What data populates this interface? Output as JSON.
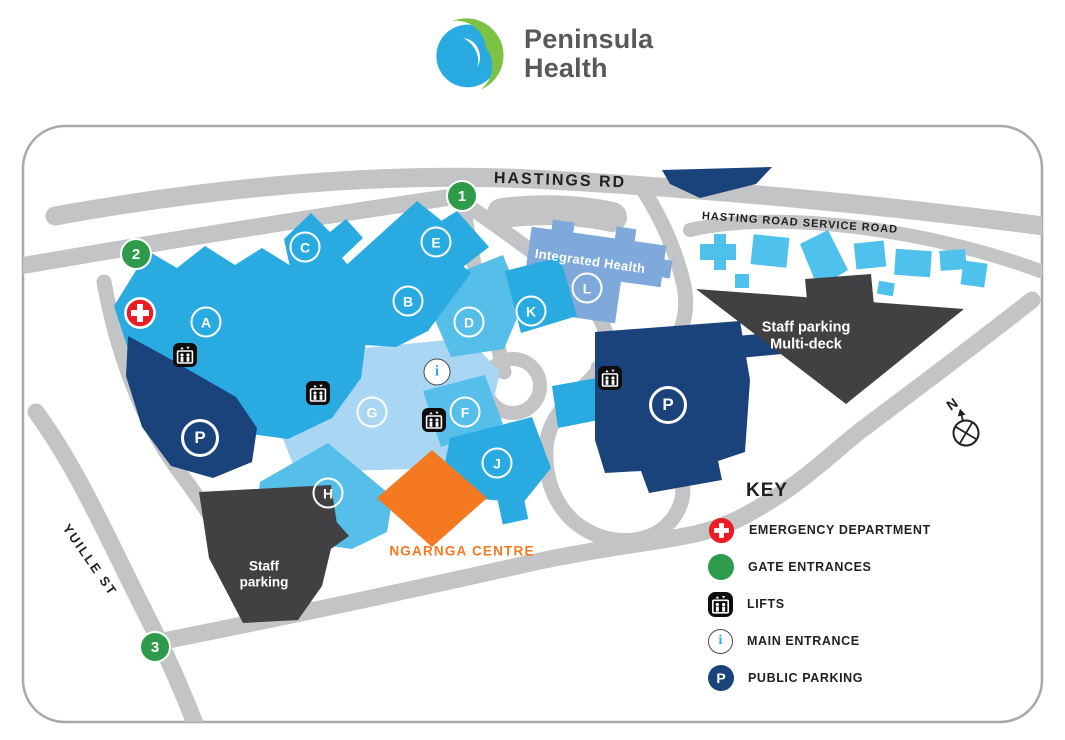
{
  "header": {
    "brand": {
      "line1": "Peninsula",
      "line2": "Health"
    }
  },
  "map": {
    "road_labels": {
      "hastings": "HASTINGS RD",
      "service": "HASTING ROAD SERVICE ROAD",
      "yuille": "YUILLE ST"
    },
    "buildings": [
      {
        "label": "A"
      },
      {
        "label": "B"
      },
      {
        "label": "C"
      },
      {
        "label": "D"
      },
      {
        "label": "E"
      },
      {
        "label": "F"
      },
      {
        "label": "G"
      },
      {
        "label": "H"
      },
      {
        "label": "J"
      },
      {
        "label": "K"
      },
      {
        "label": "L"
      }
    ],
    "gates": [
      {
        "label": "1"
      },
      {
        "label": "2"
      },
      {
        "label": "3"
      }
    ],
    "labels": {
      "integrated_health": "Integrated Health",
      "multideck_line1": "Staff parking",
      "multideck_line2": "Multi-deck",
      "staff_line1": "Staff",
      "staff_line2": "parking",
      "ngarnga": "NGARNGA CENTRE",
      "compass": "N",
      "parking": "P",
      "info": "i"
    }
  },
  "key": {
    "title": "KEY",
    "items": [
      {
        "icon": "emergency-cross-icon",
        "label": "EMERGENCY DEPARTMENT"
      },
      {
        "icon": "gate-entrance-icon",
        "label": "GATE ENTRANCES"
      },
      {
        "icon": "lift-icon",
        "label": "LIFTS"
      },
      {
        "icon": "main-entrance-icon",
        "label": "MAIN ENTRANCE"
      },
      {
        "icon": "public-parking-icon",
        "label": "PUBLIC PARKING"
      }
    ]
  },
  "colors": {
    "bright_blue": "#29ABE2",
    "mid_blue": "#55BFE9",
    "light_blue": "#A9D7F3",
    "periwinkle_blue": "#7FA9DB",
    "service_building_blue": "#4FC1ED",
    "navy": "#1A437C",
    "dark_grey": "#414042",
    "road_grey": "#C3C4C6",
    "green": "#2D9B49",
    "red": "#EC1C24",
    "orange": "#F47920",
    "logo_green": "#7DC242",
    "text_dark": "#231F20"
  }
}
